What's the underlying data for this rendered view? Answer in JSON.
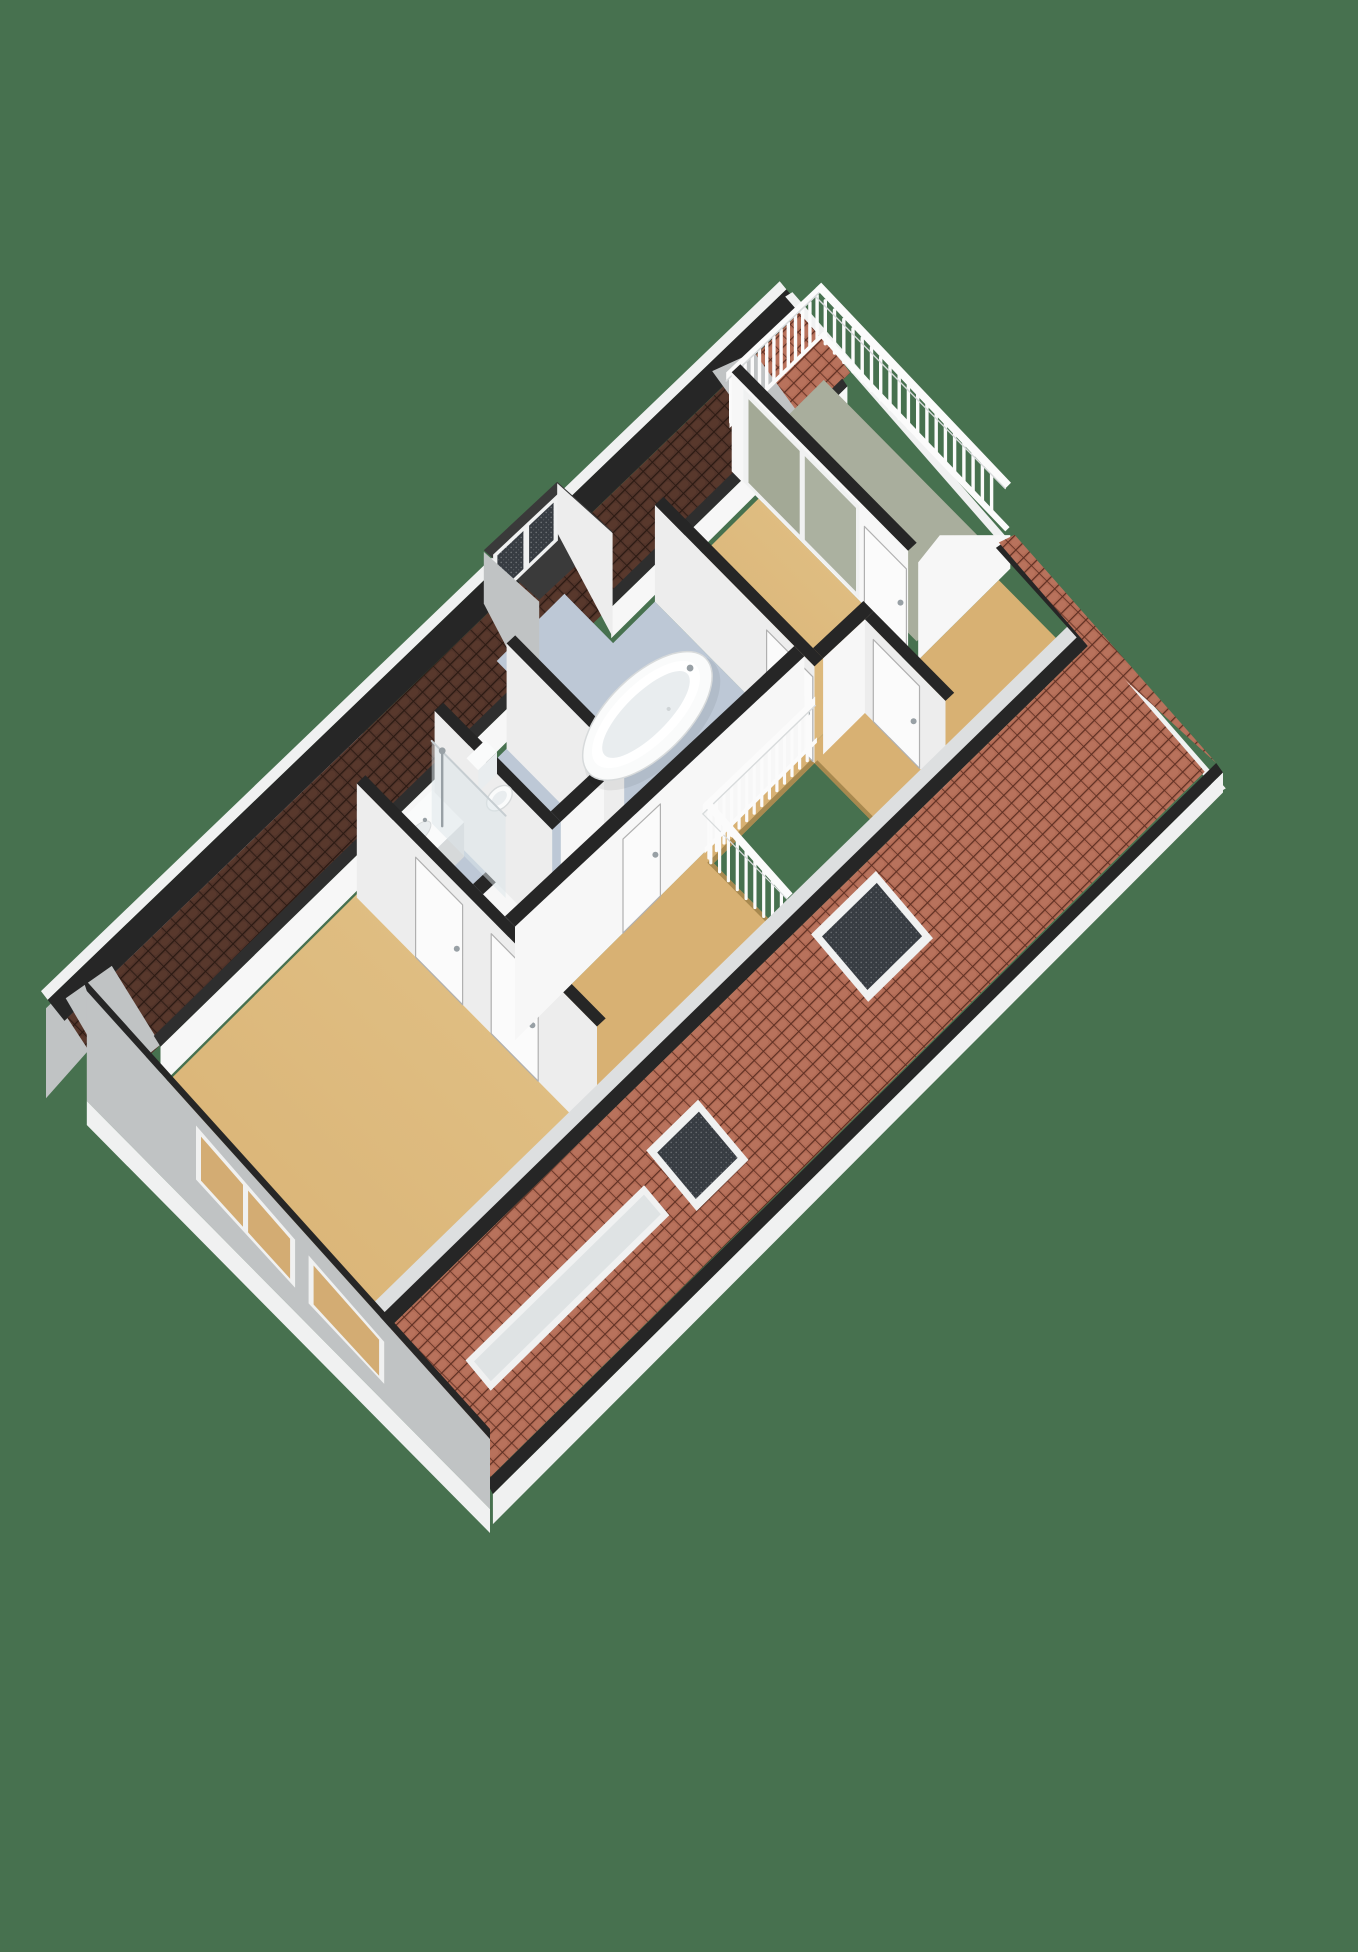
{
  "meta": {
    "title": "3D isometric floor plan of an attic storey with bedrooms, bathroom, stairwell and roof terrace"
  },
  "background": "#47714f",
  "palette": {
    "bg": "#47714f",
    "floorWood": "#d8b173",
    "floorWoodLight": "#e2c287",
    "floorWoodEdge": "#a8894f",
    "floorBath": "#bdc8d6",
    "floorBathLight": "#ccd5df",
    "floorTerrace": "#a9ae9d",
    "wallFace": "#f7f7f7",
    "wallFace2": "#ededed",
    "wallGray": "#c0c3c4",
    "wallGrayDark": "#a7abad",
    "capDark": "#262626",
    "capDark2": "#2e2e2e",
    "tileRed": "#b26b55",
    "tileRedLine": "#5e2f22",
    "tileRedHi": "#bd7660",
    "tileBrown": "#513329",
    "tileBrownLine": "#2a1912",
    "tileBrownHi": "#5e3c2e",
    "fascia": "#f0f1f1",
    "glassDark": "#373c42",
    "glassPale": "#dfe3e4",
    "glassTerrace": "#a3a996",
    "glassTerrace2": "#abb1a0",
    "chrome": "#98a0a5",
    "doorLeaf": "#fbfbfb",
    "doorEdge": "#b0b0b0",
    "fixtureWhite": "#fafbfb",
    "fixtureInner": "#e9edef",
    "fixtureStroke": "#d7dadb",
    "railWhite": "#fbfbfb",
    "railShade": "#d8dbdc"
  },
  "scene": {
    "type": "isometric-3d-floorplan",
    "storey": "attic",
    "rooms": [
      {
        "name": "bedroom-large",
        "floor": "wood",
        "features": [
          "window-strip-gable",
          "two-doors"
        ]
      },
      {
        "name": "shower-room",
        "floor": "bath-blue",
        "fixtures": [
          "vanity-sink",
          "walk-in-shower-glass"
        ]
      },
      {
        "name": "toilet-room",
        "floor": "bath-blue",
        "fixtures": [
          "toilet"
        ]
      },
      {
        "name": "bathroom",
        "floor": "bath-blue",
        "fixtures": [
          "freestanding-bathtub",
          "dormer-window",
          "shower-tray"
        ]
      },
      {
        "name": "landing",
        "floor": "wood",
        "fixtures": [
          "stairwell-opening",
          "white-balustrade"
        ]
      },
      {
        "name": "bedroom-master",
        "floor": "wood",
        "features": [
          "sliding-glass-door-to-terrace",
          "terrace-door"
        ]
      },
      {
        "name": "bedroom-small",
        "floor": "wood",
        "features": [
          "door-to-landing"
        ]
      },
      {
        "name": "roof-terrace",
        "floor": "terrace-composite",
        "fixtures": [
          "white-railing"
        ]
      }
    ],
    "exterior_features": [
      "terracotta-tiled-front-roof-slope",
      "dark-brown-rear-roof-band",
      "two-skylights",
      "long-skylight-strip",
      "dormer",
      "gray-gable-end-with-window-strip",
      "white-fascia-band"
    ]
  }
}
